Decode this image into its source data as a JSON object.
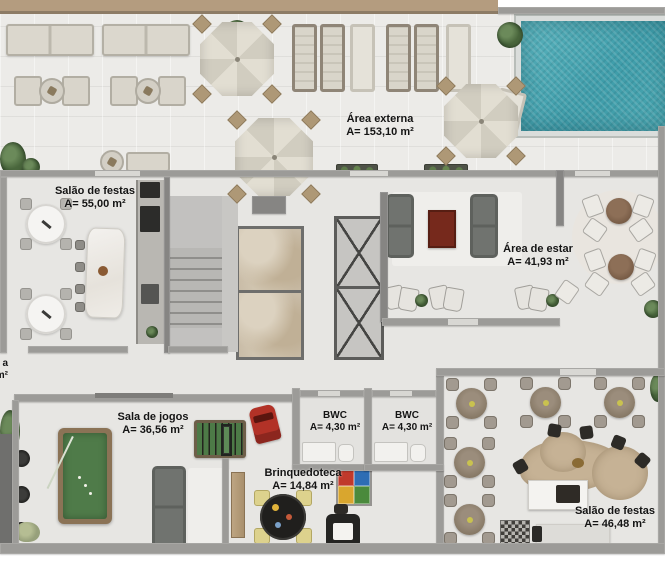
{
  "plan": {
    "rooms": [
      {
        "key": "area-externa",
        "name": "Área externa",
        "area": "A= 153,10 m²"
      },
      {
        "key": "salao-de-festas-1",
        "name": "Salão de festas",
        "area": "A= 55,00 m²"
      },
      {
        "key": "area-de-estar",
        "name": "Área de estar",
        "area": "A= 41,93 m²"
      },
      {
        "key": "sala-de-jogos",
        "name": "Sala de jogos",
        "area": "A= 36,56 m²"
      },
      {
        "key": "bwc-1",
        "name": "BWC",
        "area": "A= 4,30 m²"
      },
      {
        "key": "bwc-2",
        "name": "BWC",
        "area": "A= 4,30 m²"
      },
      {
        "key": "brinquedoteca",
        "name": "Brinquedoteca",
        "area": "A= 14,84 m²"
      },
      {
        "key": "salao-de-festas-2",
        "name": "Salão de festas",
        "area": "A= 46,48 m²"
      }
    ],
    "edge_label": {
      "line1": "a",
      "line2": "m²"
    },
    "colors": {
      "pool_water": "#45a4ae",
      "billiard_felt": "#4f7b49",
      "foosball_field": "#4d7a47",
      "top_band_tan": "#b49c7f",
      "wall_gray": "#9c9b98",
      "floor_light": "#e9e8e5",
      "accent_red": "#b13227",
      "coffee_table_maroon": "#76291c",
      "wood_counter": "#c6b295"
    }
  }
}
